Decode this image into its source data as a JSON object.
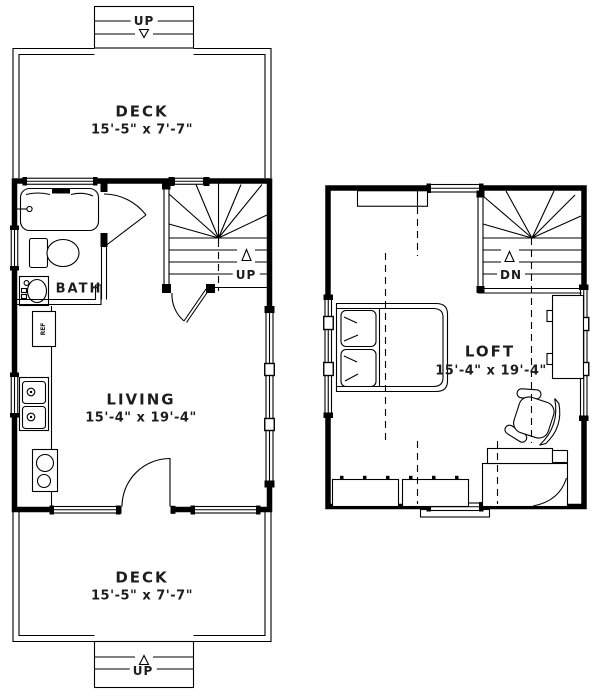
{
  "plan": {
    "colors": {
      "background": "#ffffff",
      "line": "#000000",
      "text": "#1d1d1d"
    },
    "first_floor": {
      "top_deck": {
        "label": "DECK",
        "dims": "15'-5\" x 7'-7\""
      },
      "bottom_deck": {
        "label": "DECK",
        "dims": "15'-5\" x 7'-7\""
      },
      "living": {
        "label": "LIVING",
        "dims": "15'-4\" x 19'-4\""
      },
      "bath": {
        "label": "BATH"
      },
      "fridge": {
        "label": "REF"
      },
      "interior_stairs": {
        "label": "UP"
      },
      "top_steps": {
        "label": "UP"
      },
      "bottom_steps": {
        "label": "UP"
      }
    },
    "second_floor": {
      "loft": {
        "label": "LOFT",
        "dims": "15'-4\" x 19'-4\""
      },
      "stairs": {
        "label": "DN"
      }
    }
  }
}
